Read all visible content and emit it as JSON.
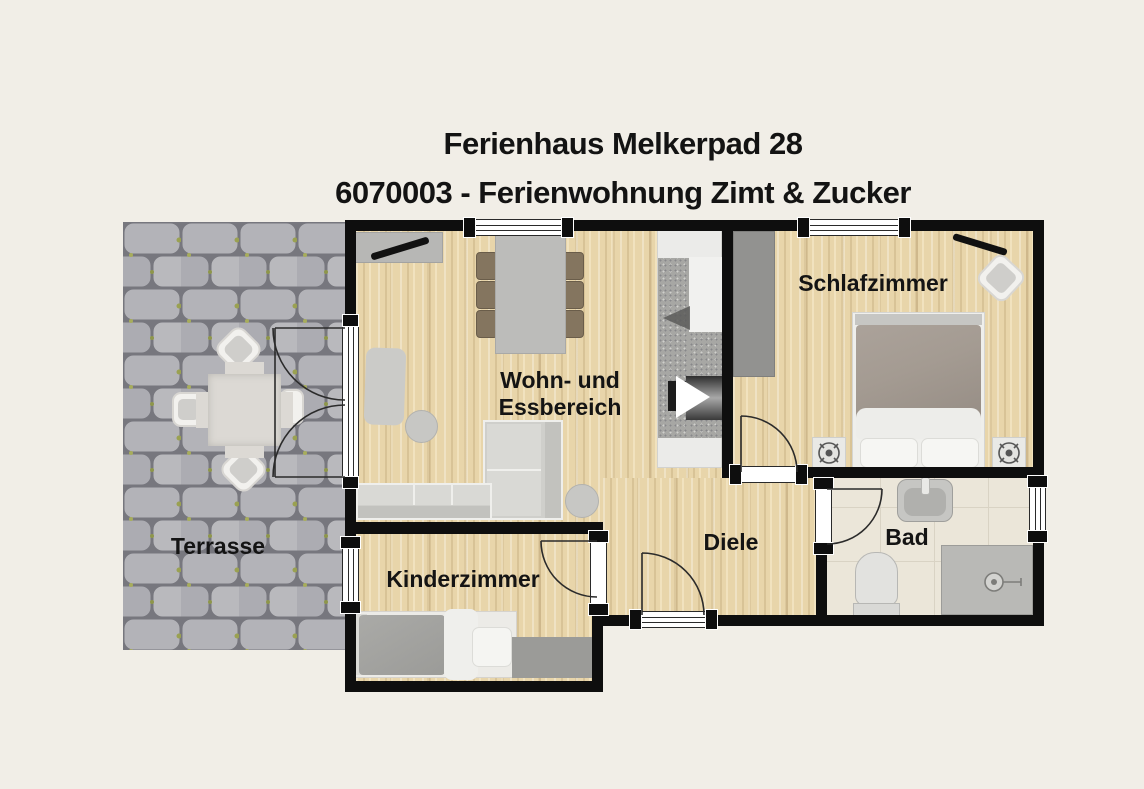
{
  "title": {
    "line1": "Ferienhaus Melkerpad 28",
    "line2": "6070003 - Ferienwohnung Zimt & Zucker"
  },
  "rooms": {
    "terrasse": {
      "label": "Terrasse"
    },
    "wohnbereich": {
      "line1": "Wohn- und",
      "line2": "Essbereich"
    },
    "schlafzimmer": {
      "label": "Schlafzimmer"
    },
    "kinderzimmer": {
      "label": "Kinderzimmer"
    },
    "diele": {
      "label": "Diele"
    },
    "bad": {
      "label": "Bad"
    }
  },
  "colors": {
    "background": "#f1eee7",
    "wall": "#0e0e0e",
    "wood_floor": "#e8d5aa",
    "tile_floor": "#ebe6d9",
    "paver_stone": "#b3b3b8",
    "paver_joint": "#77777e",
    "moss": "#9aa151",
    "text": "#131313",
    "duvet": "#a49b92",
    "furniture_gray": "#b7b7b5"
  }
}
